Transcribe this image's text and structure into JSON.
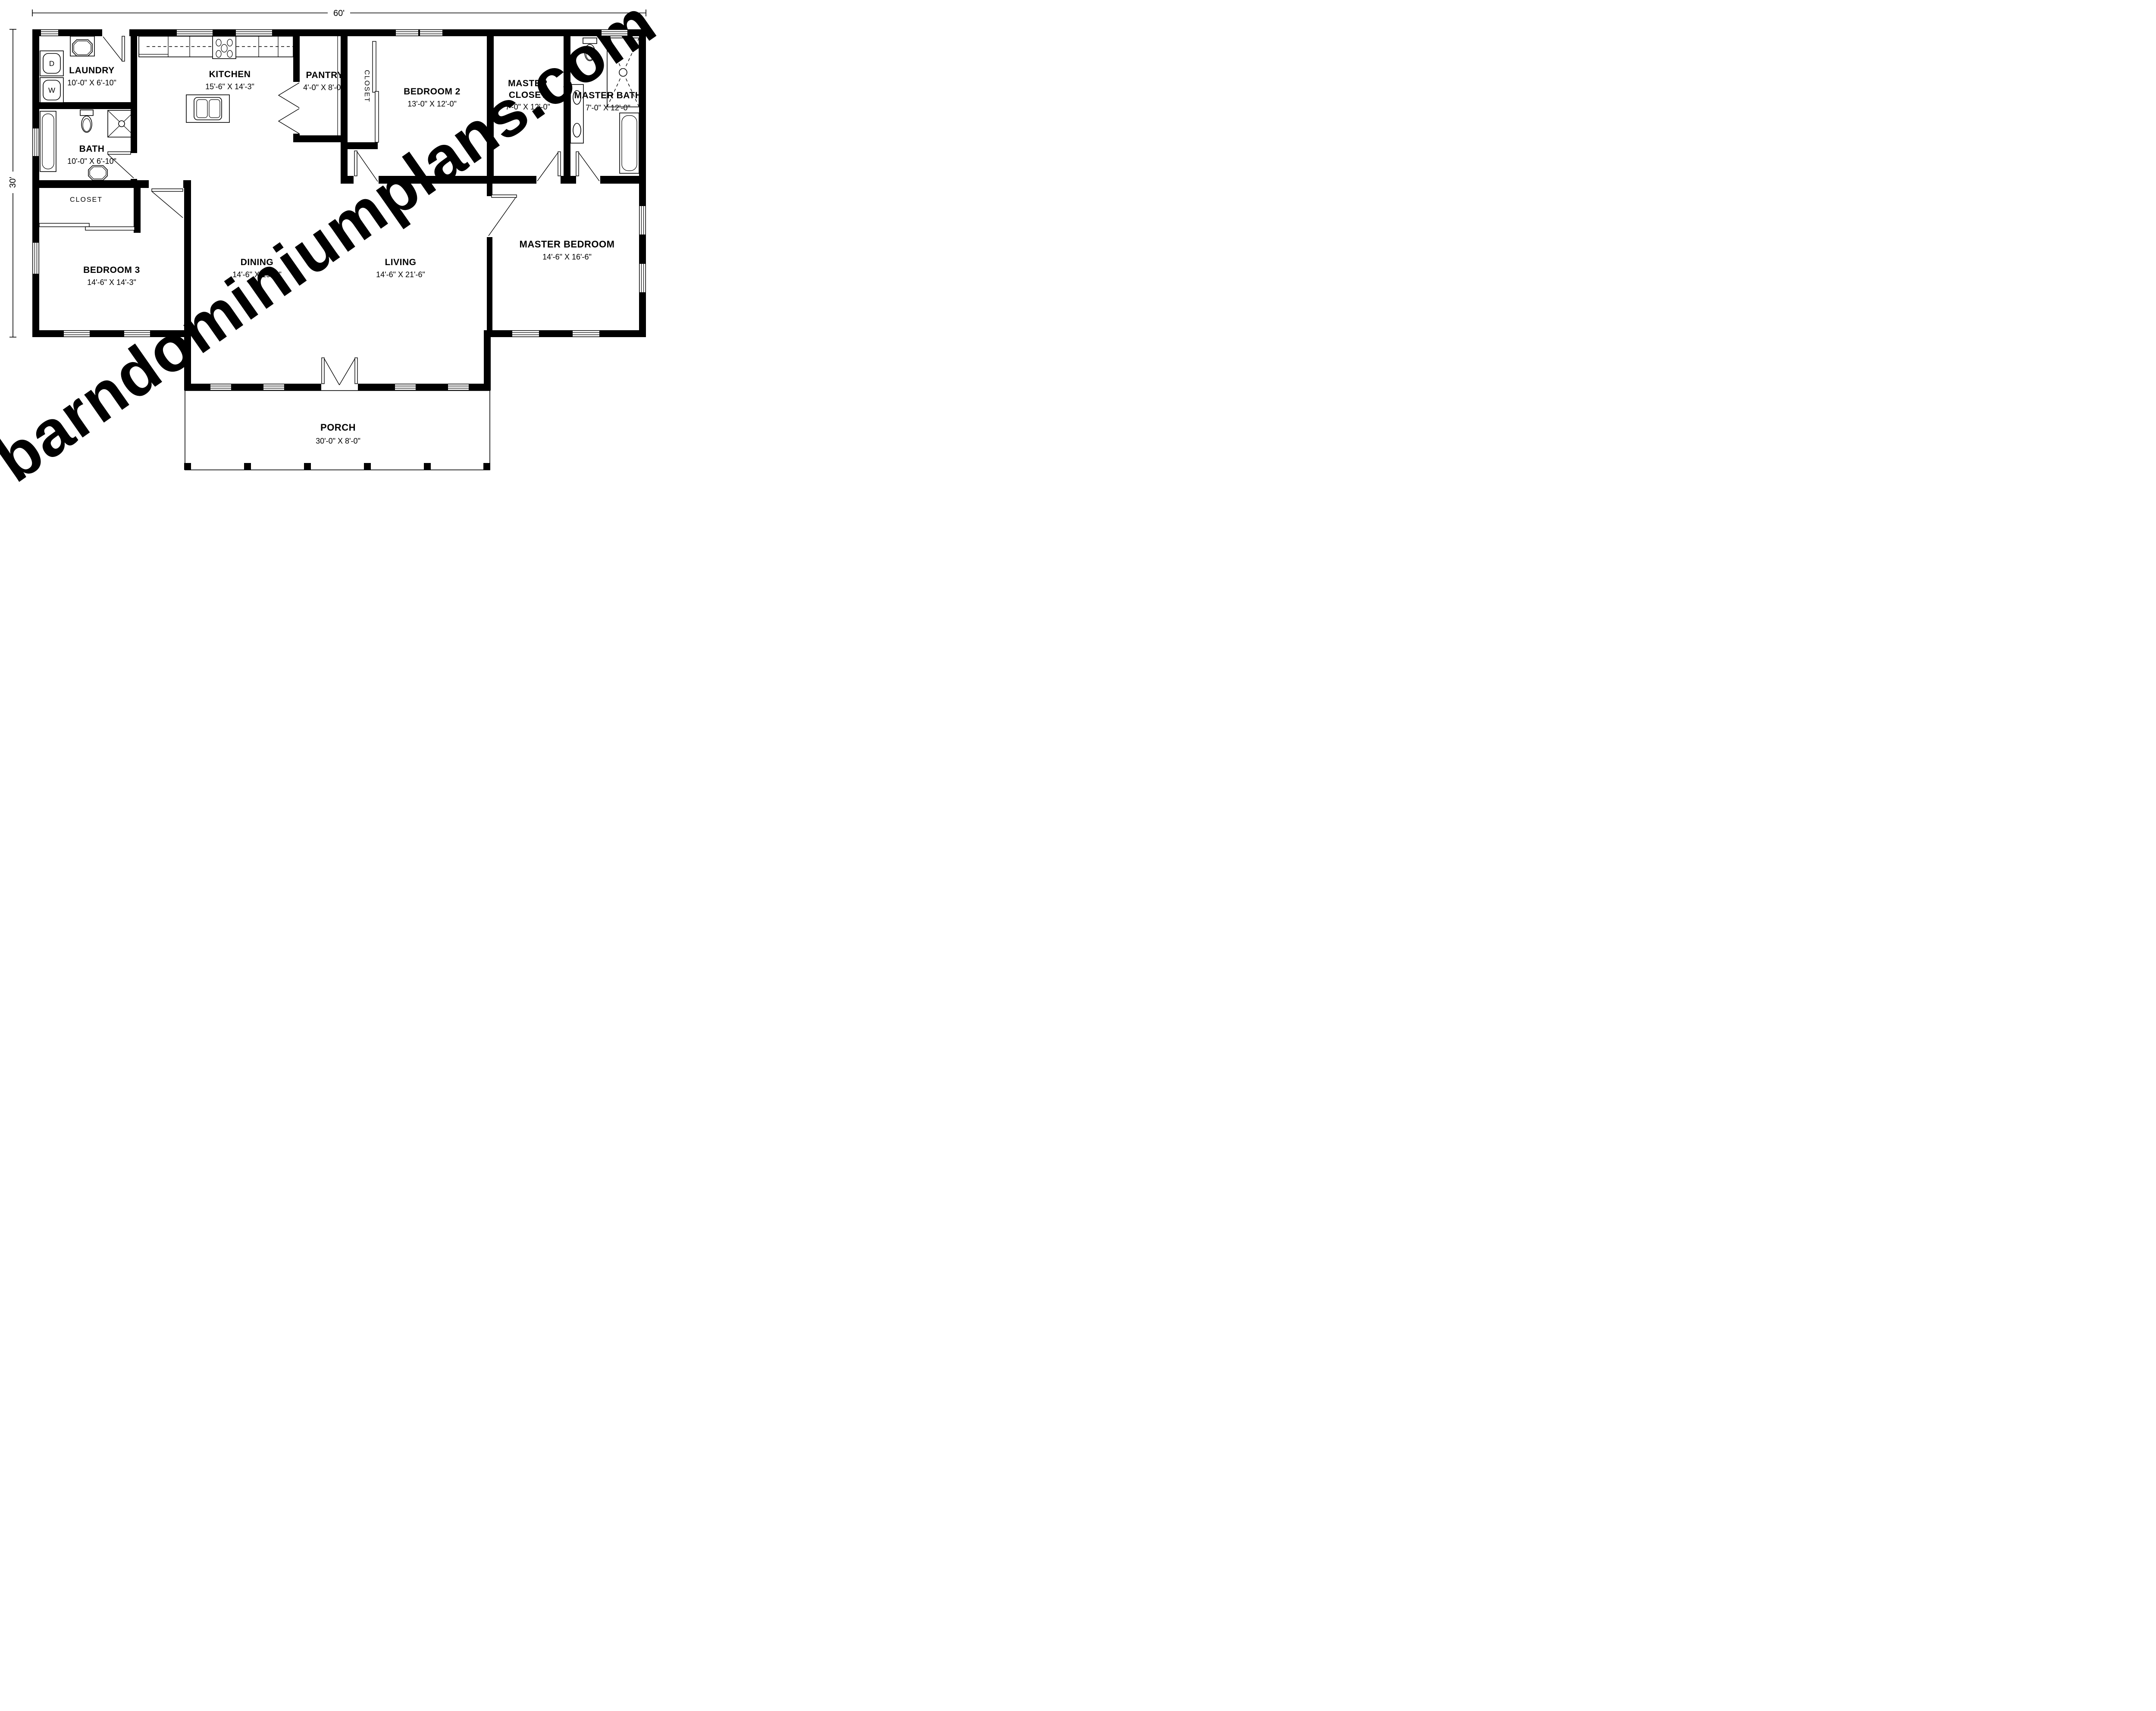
{
  "watermark": "barndominiumplans.com",
  "colors": {
    "wall": "#000000",
    "watermark": "#e9e9e9",
    "background": "#ffffff"
  },
  "overall_dimensions": {
    "width": "60'",
    "depth": "30'"
  },
  "fixtures": {
    "dryer": "D",
    "washer": "W"
  },
  "rooms": {
    "laundry": {
      "name": "LAUNDRY",
      "dims": "10'-0\" X 6'-10\""
    },
    "kitchen": {
      "name": "KITCHEN",
      "dims": "15'-6\" X 14'-3\""
    },
    "pantry": {
      "name": "PANTRY",
      "dims": "4'-0\" X 8'-0\""
    },
    "hall_closet": {
      "name": "CLOSET"
    },
    "bedroom2": {
      "name": "BEDROOM 2",
      "dims": "13'-0\" X 12'-0\""
    },
    "master_closet": {
      "line1": "MASTER",
      "line2": "CLOSET",
      "dims": "7'-0\" X 12'-0\""
    },
    "master_bath": {
      "name": "MASTER BATH",
      "dims": "7'-0\" X 12'-0\""
    },
    "bath": {
      "name": "BATH",
      "dims": "10'-0\" X 6'-10\""
    },
    "bedroom3_closet": {
      "name": "CLOSET"
    },
    "bedroom3": {
      "name": "BEDROOM 3",
      "dims": "14'-6\" X 14'-3\""
    },
    "dining": {
      "name": "DINING",
      "dims": "14'-6\" X 19'-9\""
    },
    "living": {
      "name": "LIVING",
      "dims": "14'-6\" X 21'-6\""
    },
    "master_bedroom": {
      "name": "MASTER BEDROOM",
      "dims": "14'-6\" X 16'-6\""
    },
    "porch": {
      "name": "PORCH",
      "dims": "30'-0\" X 8'-0\""
    }
  }
}
